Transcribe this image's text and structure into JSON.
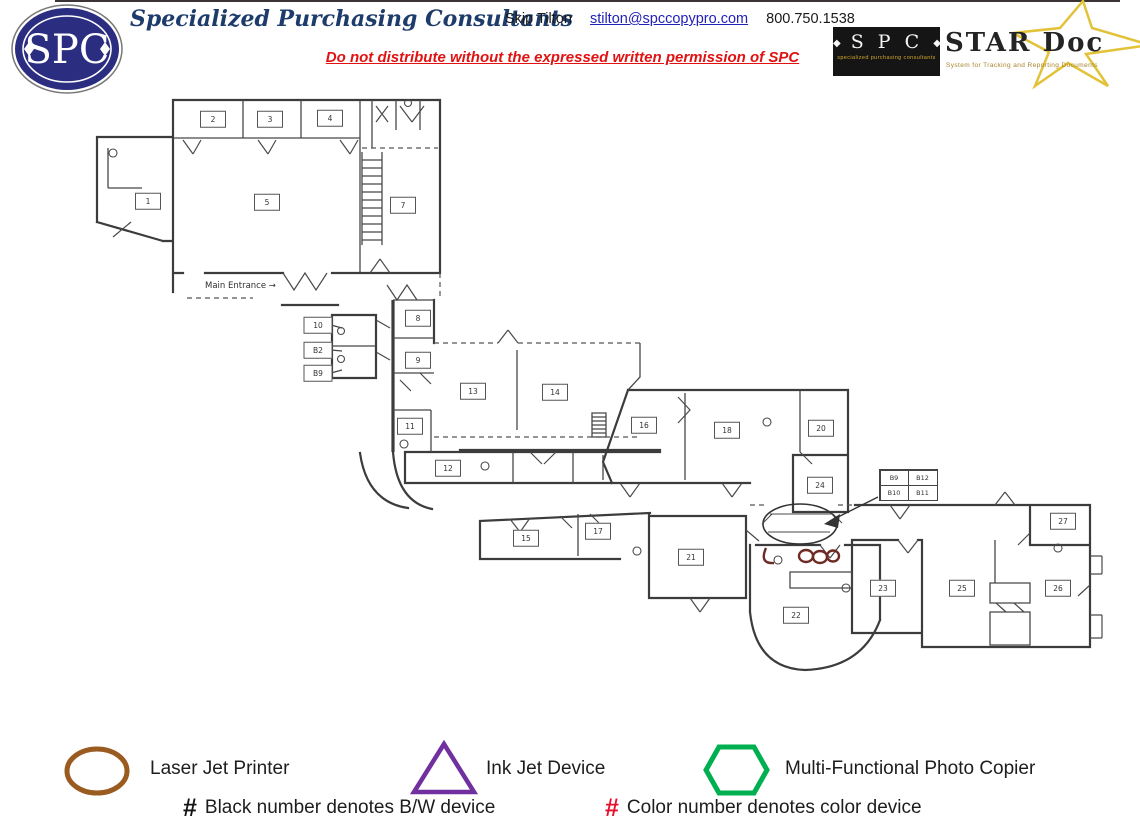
{
  "header": {
    "logo_text": "SPC",
    "company": "Specialized Purchasing Consultants",
    "contact_name": "Skip Tilton",
    "contact_email": "stilton@spccopypro.com",
    "contact_phone": "800.750.1538",
    "warning": "Do not distribute without the expressed written permission of SPC"
  },
  "stardoc_logo": {
    "spc_text": "S P C",
    "spc_subtext": "specialized purchasing consultants",
    "title": "STAR Doc",
    "tagline": "System for Tracking and Reporting Documents",
    "star_color": "#e2c238"
  },
  "floorplan": {
    "main_entrance_label": "Main Entrance →",
    "rooms": [
      {
        "n": "1",
        "x": 148,
        "y": 201
      },
      {
        "n": "2",
        "x": 213,
        "y": 119
      },
      {
        "n": "3",
        "x": 270,
        "y": 119
      },
      {
        "n": "4",
        "x": 330,
        "y": 118
      },
      {
        "n": "5",
        "x": 267,
        "y": 202
      },
      {
        "n": "7",
        "x": 403,
        "y": 205
      },
      {
        "n": "8",
        "x": 418,
        "y": 318
      },
      {
        "n": "9",
        "x": 418,
        "y": 360
      },
      {
        "n": "11",
        "x": 410,
        "y": 426
      },
      {
        "n": "12",
        "x": 448,
        "y": 468
      },
      {
        "n": "13",
        "x": 473,
        "y": 391
      },
      {
        "n": "14",
        "x": 555,
        "y": 392
      },
      {
        "n": "15",
        "x": 526,
        "y": 538
      },
      {
        "n": "16",
        "x": 644,
        "y": 425
      },
      {
        "n": "17",
        "x": 598,
        "y": 531
      },
      {
        "n": "18",
        "x": 727,
        "y": 430
      },
      {
        "n": "20",
        "x": 821,
        "y": 428
      },
      {
        "n": "21",
        "x": 691,
        "y": 557
      },
      {
        "n": "22",
        "x": 796,
        "y": 615
      },
      {
        "n": "23",
        "x": 883,
        "y": 588
      },
      {
        "n": "24",
        "x": 820,
        "y": 485
      },
      {
        "n": "25",
        "x": 962,
        "y": 588
      },
      {
        "n": "26",
        "x": 1058,
        "y": 588
      },
      {
        "n": "27",
        "x": 1063,
        "y": 521
      }
    ],
    "wall_labels": [
      {
        "n": "10",
        "x": 318,
        "y": 325
      },
      {
        "n": "B2",
        "x": 318,
        "y": 350
      },
      {
        "n": "B9",
        "x": 318,
        "y": 373
      }
    ],
    "device_table": {
      "rows": [
        [
          "B9",
          "B12"
        ],
        [
          "B10",
          "B11"
        ]
      ]
    }
  },
  "legend": {
    "items": [
      {
        "shape": "ellipse",
        "label": "Laser Jet Printer",
        "color": "#9a5b21"
      },
      {
        "shape": "triangle",
        "label": "Ink Jet Device",
        "color": "#7030a0"
      },
      {
        "shape": "hexagon",
        "label": "Multi-Functional Photo Copier",
        "color": "#00b050"
      }
    ],
    "notes": [
      {
        "symbol": "#",
        "color": "#151515",
        "text": "Black number denotes B/W device"
      },
      {
        "symbol": "#",
        "color": "#e8112d",
        "text": "Color number denotes color device"
      }
    ]
  }
}
